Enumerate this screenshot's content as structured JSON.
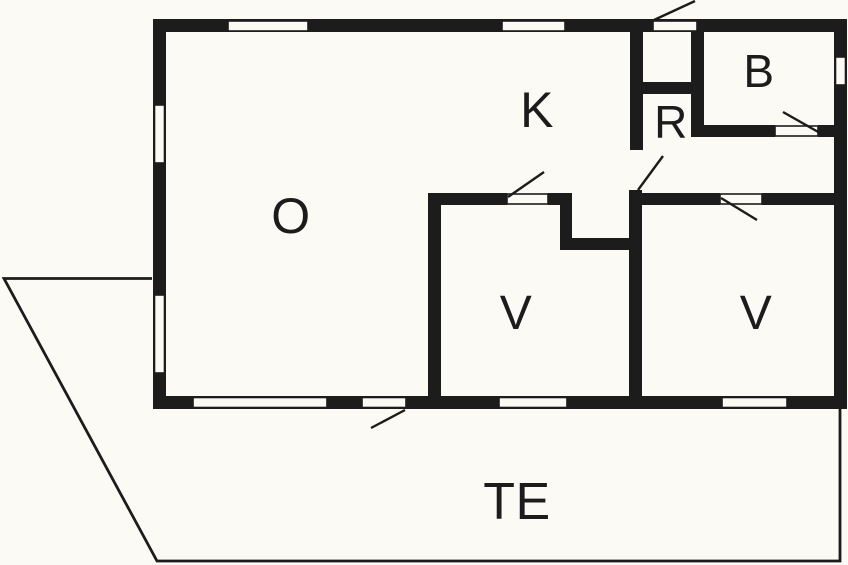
{
  "plan": {
    "rooms": [
      {
        "id": "room-o",
        "label": "O"
      },
      {
        "id": "room-k",
        "label": "K"
      },
      {
        "id": "room-r",
        "label": "R"
      },
      {
        "id": "room-b",
        "label": "B"
      },
      {
        "id": "room-v-left",
        "label": "V"
      },
      {
        "id": "room-v-right",
        "label": "V"
      },
      {
        "id": "terrace",
        "label": "TE"
      }
    ],
    "colors": {
      "wall": "#1c1c1c",
      "background": "#fbfaf4"
    }
  }
}
